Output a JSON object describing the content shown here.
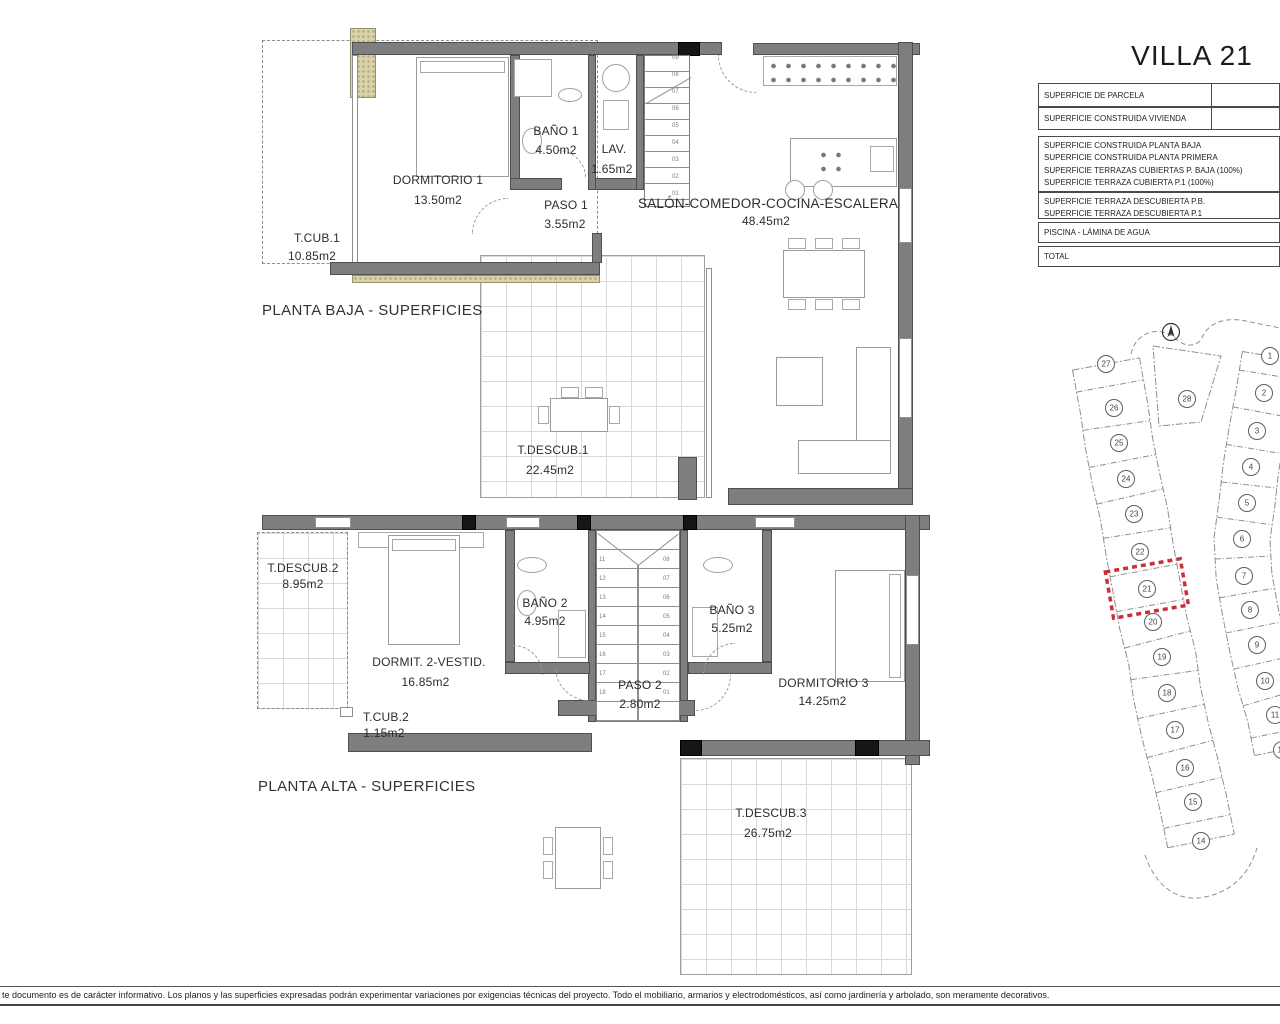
{
  "title": "VILLA 21",
  "summary_table": {
    "rows": [
      {
        "lines": [
          "SUPERFICIE DE PARCELA"
        ]
      },
      {
        "lines": [
          "SUPERFICIE CONSTRUIDA VIVIENDA"
        ]
      },
      {
        "lines": [
          "SUPERFICIE CONSTRUIDA PLANTA BAJA",
          "SUPERFICIE CONSTRUIDA PLANTA PRIMERA",
          "SUPERFICIE TERRAZAS CUBIERTAS P. BAJA (100%)",
          "SUPERFICIE TERRAZA CUBIERTA P.1 (100%)"
        ]
      },
      {
        "lines": [
          "SUPERFICIE TERRAZA DESCUBIERTA P.B.",
          "SUPERFICIE TERRAZA DESCUBIERTA P.1"
        ]
      },
      {
        "lines": [
          "PISCINA - LÁMINA DE AGUA"
        ]
      },
      {
        "lines": [
          "TOTAL"
        ]
      }
    ]
  },
  "planta_baja": {
    "caption": "PLANTA BAJA - SUPERFICIES",
    "rooms": [
      {
        "name": "DORMITORIO 1",
        "area": "13.50m2"
      },
      {
        "name": "BAÑO 1",
        "area": "4.50m2"
      },
      {
        "name": "LAV.",
        "area": "1.65m2"
      },
      {
        "name": "PASO 1",
        "area": "3.55m2"
      },
      {
        "name": "T.CUB.1",
        "area": "10.85m2"
      },
      {
        "name": "SALÓN-COMEDOR-COCINA-ESCALERA",
        "area": "48.45m2"
      },
      {
        "name": "T.DESCUB.1",
        "area": "22.45m2"
      }
    ]
  },
  "planta_alta": {
    "caption": "PLANTA ALTA - SUPERFICIES",
    "rooms": [
      {
        "name": "T.DESCUB.2",
        "area": "8.95m2"
      },
      {
        "name": "DORMIT. 2-VESTID.",
        "area": "16.85m2"
      },
      {
        "name": "BAÑO 2",
        "area": "4.95m2"
      },
      {
        "name": "BAÑO 3",
        "area": "5.25m2"
      },
      {
        "name": "PASO 2",
        "area": "2.80m2"
      },
      {
        "name": "DORMITORIO 3",
        "area": "14.25m2"
      },
      {
        "name": "T.CUB.2",
        "area": "1.15m2"
      },
      {
        "name": "T.DESCUB.3",
        "area": "26.75m2"
      }
    ]
  },
  "stairs": {
    "pb": [
      "01",
      "02",
      "03",
      "04",
      "05",
      "06",
      "07",
      "08",
      "09"
    ],
    "pa_left": [
      "11",
      "12",
      "13",
      "14",
      "15",
      "16",
      "17",
      "18"
    ],
    "pa_right": [
      "08",
      "07",
      "06",
      "05",
      "04",
      "03",
      "02",
      "01"
    ]
  },
  "site_plan": {
    "highlighted_plot": "21",
    "middle": {
      "n": "28",
      "x": 152,
      "y": 89
    },
    "left_column": [
      {
        "n": "27",
        "x": 71,
        "y": 54
      },
      {
        "n": "26",
        "x": 79,
        "y": 98
      },
      {
        "n": "25",
        "x": 84,
        "y": 133
      },
      {
        "n": "24",
        "x": 91,
        "y": 169
      },
      {
        "n": "23",
        "x": 99,
        "y": 204
      },
      {
        "n": "22",
        "x": 105,
        "y": 242
      },
      {
        "n": "21",
        "x": 112,
        "y": 279
      },
      {
        "n": "20",
        "x": 118,
        "y": 312
      },
      {
        "n": "19",
        "x": 127,
        "y": 347
      },
      {
        "n": "18",
        "x": 132,
        "y": 383
      },
      {
        "n": "17",
        "x": 140,
        "y": 420
      },
      {
        "n": "16",
        "x": 150,
        "y": 458
      },
      {
        "n": "15",
        "x": 158,
        "y": 492
      },
      {
        "n": "14",
        "x": 166,
        "y": 531
      }
    ],
    "right_column": [
      {
        "n": "1",
        "x": 235,
        "y": 46
      },
      {
        "n": "2",
        "x": 229,
        "y": 83
      },
      {
        "n": "3",
        "x": 222,
        "y": 121
      },
      {
        "n": "4",
        "x": 216,
        "y": 157
      },
      {
        "n": "5",
        "x": 212,
        "y": 193
      },
      {
        "n": "6",
        "x": 207,
        "y": 229
      },
      {
        "n": "7",
        "x": 209,
        "y": 266
      },
      {
        "n": "8",
        "x": 215,
        "y": 300
      },
      {
        "n": "9",
        "x": 222,
        "y": 335
      },
      {
        "n": "10",
        "x": 230,
        "y": 371
      },
      {
        "n": "11",
        "x": 240,
        "y": 405
      },
      {
        "n": "12",
        "x": 247,
        "y": 440
      }
    ]
  },
  "disclaimer": "te documento es de carácter informativo. Los planos y las superficies expresadas podrán experimentar variaciones por exigencias técnicas del proyecto. Todo el mobiliario, armarios y electrodomésticos, así como jardinería y arbolado, son meramente decorativos.",
  "colors": {
    "wall": "#7e7e7e",
    "hatch": "#d9d2ab",
    "highlight": "#c9303c"
  }
}
